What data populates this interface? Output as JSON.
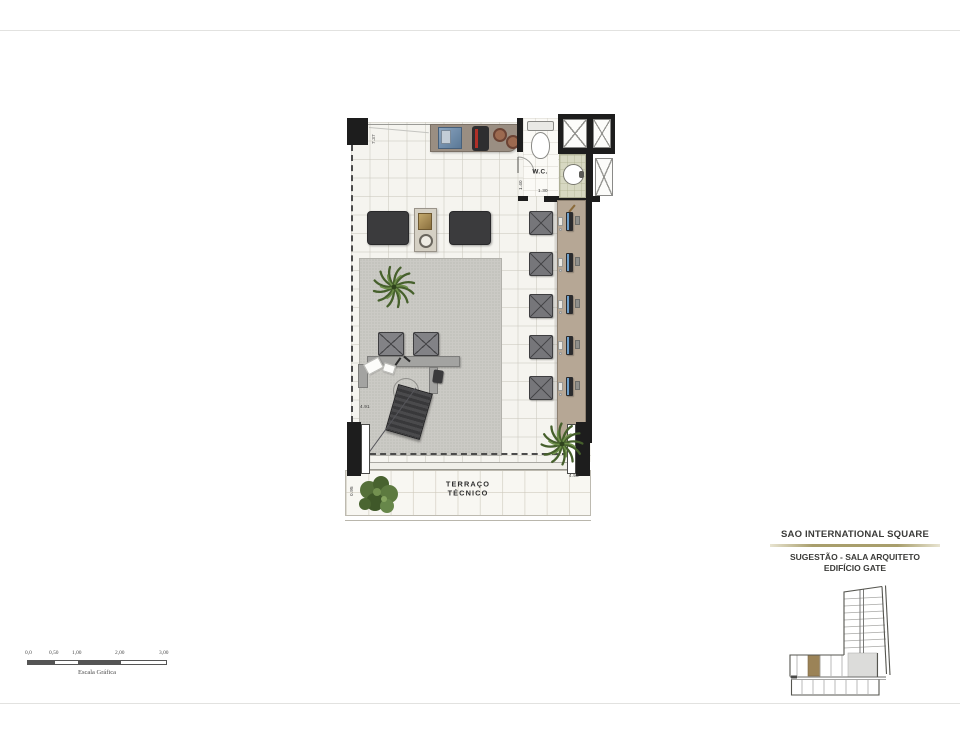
{
  "plan": {
    "labels": {
      "wc": "W.C.",
      "terrace_line1": "TERRAÇO",
      "terrace_line2": "TÉCNICO"
    },
    "dimensions": {
      "top_width": "7.37",
      "wc_depth": "1.40",
      "wc_width": "1.30",
      "room_depth": "4.91",
      "terrace_width": "4.98",
      "terrace_depth": "0.95"
    }
  },
  "scale_bar": {
    "ticks": [
      "0,0",
      "0,50",
      "1,00",
      "2,00",
      "3,00"
    ],
    "caption": "Escala Gráfica"
  },
  "title_block": {
    "project": "SAO INTERNATIONAL SQUARE",
    "subtitle_line1": "SUGESTÃO - SALA ARQUITETO",
    "subtitle_line2": "EDIFÍCIO GATE"
  },
  "colors": {
    "wall": "#1d1d1d",
    "floor_tile": "#f5f4ef",
    "carpet": "#cbcac5",
    "desk_right": "#b6a795",
    "kitchen_counter": "#9a8e82",
    "basin_counter": "#d7d8c2",
    "separator_accent": "#a89e6c",
    "plant_green": "#46602c",
    "diagram_highlight": "#9b8357"
  }
}
